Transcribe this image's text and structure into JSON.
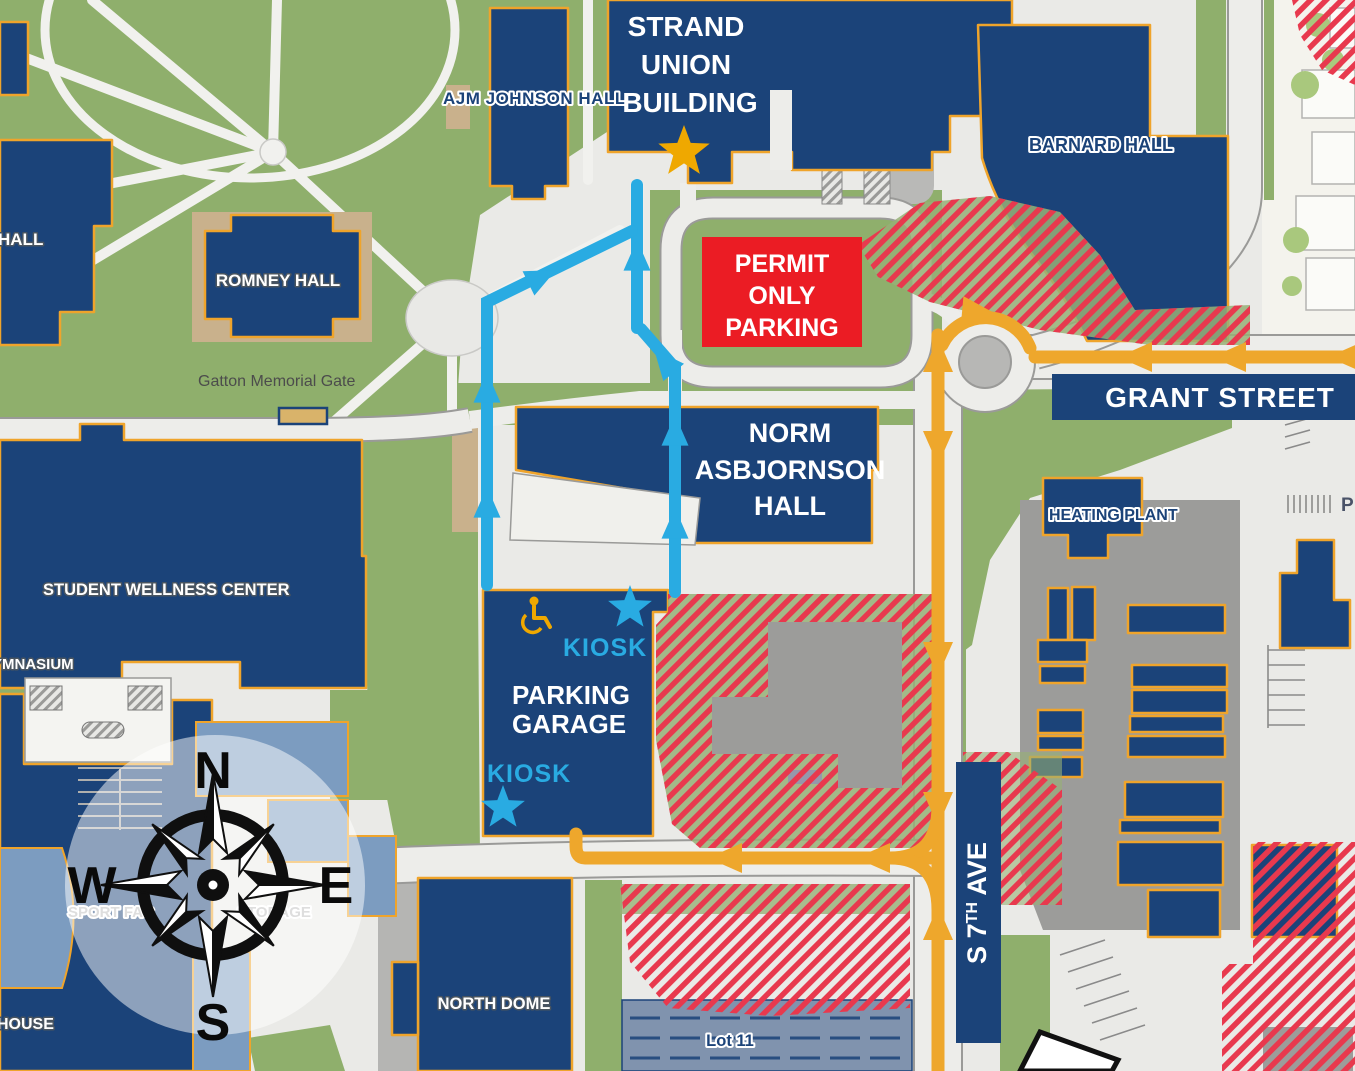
{
  "map": {
    "labels": {
      "hall_partial": "HALL",
      "ajm_johnson": "AJM JOHNSON HALL",
      "strand_union": [
        "STRAND",
        "UNION",
        "BUILDING"
      ],
      "barnard": "BARNARD HALL",
      "romney": "ROMNEY HALL",
      "gatton_gate": "Gatton Memorial Gate",
      "permit_sign": [
        "PERMIT",
        "ONLY",
        "PARKING"
      ],
      "grant_street": "GRANT STREET",
      "norm_asbjornson": [
        "NORM",
        "ASBJORNSON",
        "HALL"
      ],
      "heating_plant": "HEATING PLANT",
      "student_wellness": "STUDENT WELLNESS CENTER",
      "gymnasium_partial": "YMNASIUM",
      "kiosk_upper": "KIOSK",
      "kiosk_lower": "KIOSK",
      "parking_garage": [
        "PARKING",
        "GARAGE"
      ],
      "sport_fac_partial": "SPORT FAC",
      "storage_partial": "STORAGE",
      "house_partial": "HOUSE",
      "north_dome": "NORTH DOME",
      "lot_11": "Lot 11",
      "s7th_ave": {
        "p1": "S 7",
        "sup": "TH",
        "p2": " AVE"
      },
      "parking_p": "P",
      "compass": {
        "n": "N",
        "e": "E",
        "s": "S",
        "w": "W"
      }
    },
    "colors": {
      "building_navy": "#1b4379",
      "building_outline": "#efa42b",
      "route_orange": "#eea72c",
      "route_blue": "#29abe2",
      "permit_red": "#eb1c24",
      "hatch_red": "#e8394e",
      "grass_green": "#8faf6c",
      "steel_blue": "#7c9cc0",
      "banner_navy": "#1b4379",
      "star_gold": "#efa800",
      "kiosk_blue": "#29abe2"
    },
    "icons": [
      "compass-rose",
      "gold-star-icon",
      "kiosk-star-icon",
      "accessible-parking-icon"
    ]
  }
}
